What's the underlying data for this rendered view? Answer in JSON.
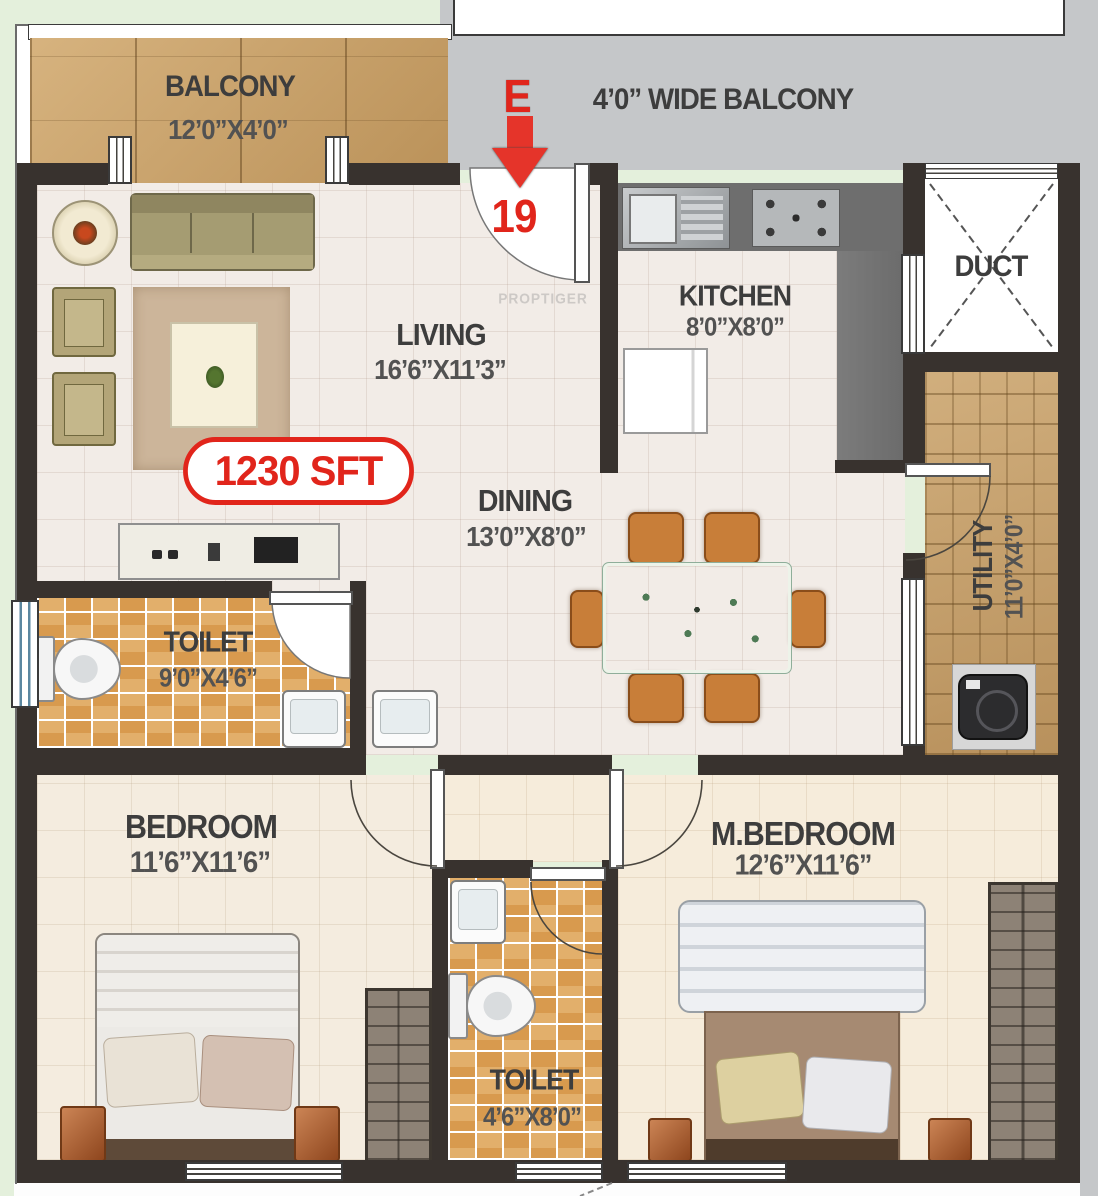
{
  "plan": {
    "title": "apartment-floor-plan",
    "area_badge": "1230 SFT",
    "watermark": "PROPTIGER",
    "entrance": {
      "compass_letter": "E",
      "unit_number": "19"
    },
    "rooms": {
      "balcony": {
        "name": "BALCONY",
        "dims": "12’0”X4’0”"
      },
      "wide_balcony": {
        "name": "4’0” WIDE BALCONY"
      },
      "living": {
        "name": "LIVING",
        "dims": "16’6”X11’3”"
      },
      "kitchen": {
        "name": "KITCHEN",
        "dims": "8’0”X8’0”"
      },
      "duct": {
        "name": "DUCT"
      },
      "dining": {
        "name": "DINING",
        "dims": "13’0”X8’0”"
      },
      "utility": {
        "name": "UTILITY",
        "dims": "11’0”X4’0”"
      },
      "toilet_common": {
        "name": "TOILET",
        "dims": "9’0”X4’6”"
      },
      "bedroom": {
        "name": "BEDROOM",
        "dims": "11’6”X11’6”"
      },
      "toilet_master": {
        "name": "TOILET",
        "dims": "4’6”X8’0”"
      },
      "master_bedroom": {
        "name": "M.BEDROOM",
        "dims": "12’6”X11’6”"
      }
    },
    "colors": {
      "accent_red": "#e1251b",
      "wall": "#38322e",
      "balcony_wood": "#c9a066",
      "toilet_tile": "#d89a4e",
      "wide_balcony_gray": "#c5c7c9",
      "margin_green": "#e4f0dc",
      "floor_light": "#f2ece7",
      "floor_bedroom": "#f4ecdf"
    }
  }
}
